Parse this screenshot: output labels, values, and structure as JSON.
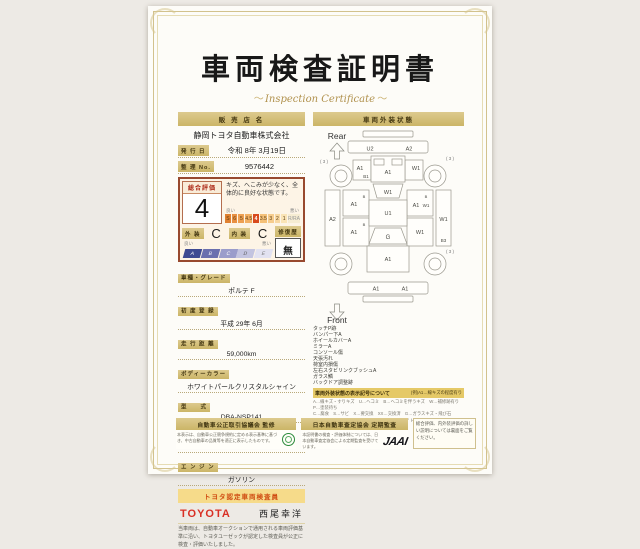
{
  "page": {
    "title": "車両検査証明書",
    "subtitle": "Inspection Certificate"
  },
  "seller": {
    "header": "販 売 店 名",
    "name": "静岡トヨタ自動車株式会社",
    "issue_date_label": "発 行 日",
    "issue_date": "令和 8年 3月19日",
    "ref_no_label": "整 理 No.",
    "ref_no": "9576442"
  },
  "evaluation": {
    "overall_label": "総合評価",
    "overall_score": "4",
    "comment": "キズ、へこみが少なく、全体的に良好な状態です。",
    "good_label": "良い",
    "bad_label": "悪い",
    "scale_cells": [
      "S",
      "6",
      "5",
      "4.5",
      "4",
      "3.5",
      "3",
      "2",
      "1"
    ],
    "scale_r_cell": "R/RA",
    "exterior_label": "外 装",
    "exterior_grade": "C",
    "interior_label": "内 装",
    "interior_grade": "C",
    "repair_label": "修復歴",
    "repair_value": "無",
    "grade_cells": [
      "A",
      "B",
      "C",
      "D",
      "E"
    ]
  },
  "details": {
    "rows": [
      {
        "label": "車種・グレード",
        "value": "ポルテ F"
      },
      {
        "label": "初 度 登 録",
        "value": "平成 29年 6月"
      },
      {
        "label": "走 行 距 離",
        "value": "59,000km"
      },
      {
        "label": "ボディーカラー",
        "value": "ホワイトパールクリスタルシャイン"
      },
      {
        "label": "型　　式",
        "value": "DBA-NSP141"
      },
      {
        "label": "車 台 番 号",
        "value": "XXXXXXX59B"
      },
      {
        "label": "エ ン ジ ン",
        "value": "ガソリン"
      }
    ]
  },
  "inspector": {
    "badge": "トヨタ認定車両検査員",
    "brand": "TOYOTA",
    "name": "西尾幸洋",
    "note": "当車両は、自動車オークションで通用される車両評価基準に沿い、トヨタユーゼックが認定した検査員が公正に検査・評価いたしました。"
  },
  "exterior_panel": {
    "header": "車両外装状態",
    "checklist": [
      "タッチP跡",
      "バンパー下A",
      "ホイールカバーA",
      "ミラーA",
      "コンソール傷",
      "天張汚れ",
      "荷室内損傷",
      "左右スタビリンクブッシュA",
      "ガラス鱗",
      "バックドア調整跡"
    ],
    "legend_title": "車両外装状態の表示記号について",
    "legend_example": "(例)A1…線キズの程度有り",
    "legend_lines": [
      "A…線キズ・すりキズ　U…ヘコミ　B…ヘコミを伴うキズ　W…補修跡有り　P…塗装待ち",
      "C…腐食　S…サビ　X…要交換　XX…交換済　G…ガラスキズ・飛び石",
      "1…小程度　2…中程度　3…中程度以上　※スライト傷は表示していません。"
    ],
    "diagram": {
      "rear_label": "Rear",
      "front_label": "Front",
      "rear_bumper_l": "U2",
      "rear_bumper_r": "A2",
      "mark3_tl": "( 3 )",
      "mark3_tr": "( 3 )",
      "mark3_br": "( 3 )",
      "lf_fender": "A1",
      "lf_fender2": "B1",
      "rf_fender": "W1",
      "left_strip": "A2",
      "left_door_f": "A1",
      "left_door_f_mark": "B",
      "left_door_r": "A1",
      "left_door_r_mark": "B",
      "right_door_f": "A1",
      "right_door_f_mark": "B",
      "right_door_f2": "W1",
      "right_door_r": "W1",
      "right_strip": "W1",
      "right_low": "B3",
      "trunk": "A1",
      "rear_glass": "W1",
      "roof": "U1",
      "windshield": "G",
      "hood": "A1",
      "front_bumper_l": "A1",
      "front_bumper_r": "A1"
    }
  },
  "footer": {
    "council": {
      "header": "自動車公正取引協議会 監修",
      "note": "本表示は、自動車公正競争規約に定める表示基準に基づき、中古自動車の品質等を適正に表示したものです。"
    },
    "jaai": {
      "header": "日本自動車査定協会 定期監査",
      "note": "本証明書の検査・評価体制については、日本自動車査定協会による定期監査を受けています。",
      "logo": "JAAI"
    },
    "back_note": "総合評価、内外装評価の詳しい説明については裏面をご覧ください。"
  },
  "colors": {
    "accent_gold": "#cbb567",
    "toyota_red": "#d93025",
    "eval_border": "#98492f",
    "badge_orange": "#cf4a10",
    "scale_highlight": "#d84a1e"
  }
}
